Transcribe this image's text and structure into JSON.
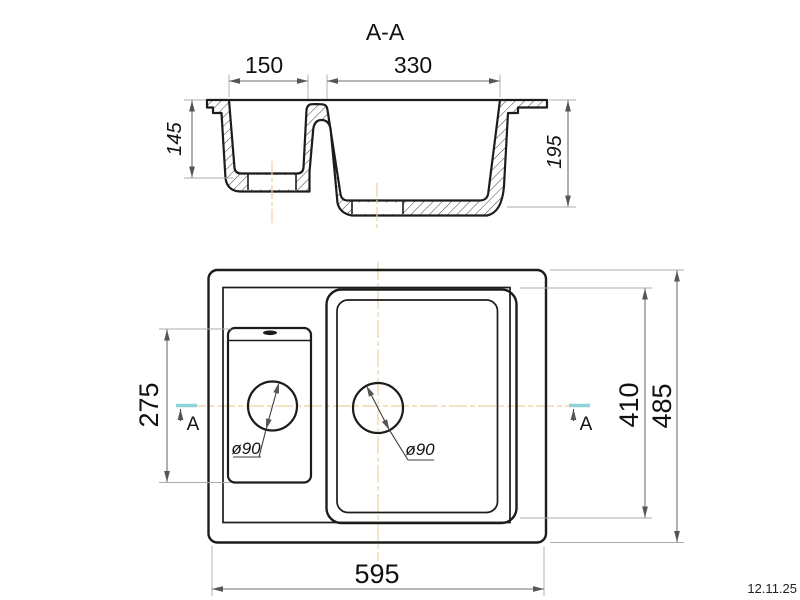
{
  "page": {
    "date_note": "12.11.25"
  },
  "colors": {
    "centerline": "#edd0a2",
    "section_marker_tick": "#8fd3d8",
    "main_line": "#1c1c1c",
    "dim_line": "#707070",
    "ext_line": "#ababab"
  },
  "section_view": {
    "title": "A-A",
    "dim_small_bowl_width": "150",
    "dim_large_bowl_width": "330",
    "dim_small_bowl_depth": "145",
    "dim_large_bowl_depth": "195"
  },
  "plan_view": {
    "dim_overall_width": "595",
    "dim_overall_depth": "485",
    "dim_bowl_area_depth": "410",
    "dim_small_bowl_length": "275",
    "drain_left_label": "ø90",
    "drain_right_label": "ø90",
    "section_marker_left": "A",
    "section_marker_right": "A"
  }
}
